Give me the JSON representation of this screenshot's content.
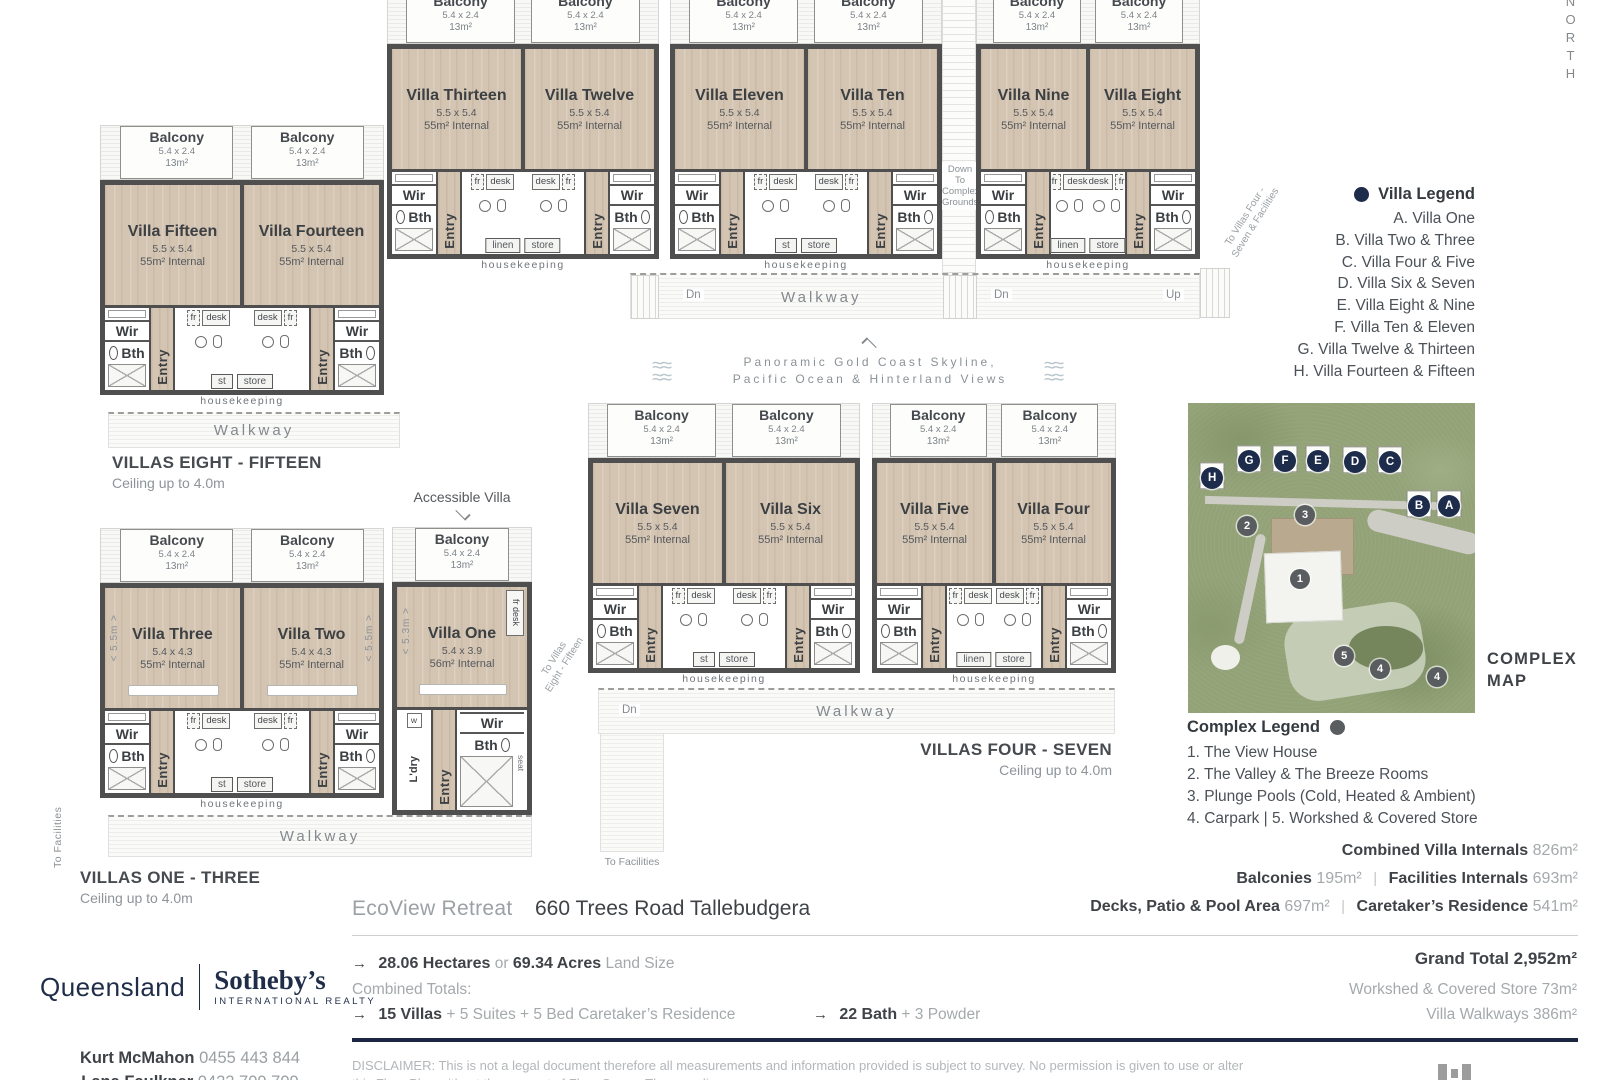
{
  "colors": {
    "navy": "#1e2c4c",
    "wall": "#4f4f50",
    "wood": "#d4c4b2",
    "map_green": "#93a277",
    "rule_navy": "#1b2742",
    "gray_text": "#9aa0a4"
  },
  "north": "NORTH",
  "unit_labels": {
    "balcony": "Balcony",
    "balcony_dims": "5.4 x 2.4",
    "balcony_area": "13m²",
    "wir": "Wir",
    "bth": "Bth",
    "entry": "Entry",
    "fr": "fr",
    "desk": "desk",
    "housekeeping": "housekeeping"
  },
  "pairs": [
    {
      "left": {
        "name": "Villa Thirteen",
        "dims": "5.5 x 5.4",
        "internal": "55m² Internal"
      },
      "right": {
        "name": "Villa Twelve",
        "dims": "5.5 x 5.4",
        "internal": "55m² Internal"
      },
      "store_left": "linen",
      "store_right": "store",
      "box": {
        "l": 387,
        "t": -11,
        "w": 272
      }
    },
    {
      "left": {
        "name": "Villa Eleven",
        "dims": "5.5 x 5.4",
        "internal": "55m² Internal"
      },
      "right": {
        "name": "Villa Ten",
        "dims": "5.5 x 5.4",
        "internal": "55m² Internal"
      },
      "store_left": "st",
      "store_right": "store",
      "box": {
        "l": 670,
        "t": -11,
        "w": 272
      }
    },
    {
      "left": {
        "name": "Villa Nine",
        "dims": "5.5 x 5.4",
        "internal": "55m² Internal"
      },
      "right": {
        "name": "Villa Eight",
        "dims": "5.5 x 5.4",
        "internal": "55m² Internal"
      },
      "store_left": "linen",
      "store_right": "store",
      "box": {
        "l": 976,
        "t": -11,
        "w": 224
      }
    },
    {
      "left": {
        "name": "Villa Fifteen",
        "dims": "5.5 x 5.4",
        "internal": "55m² Internal"
      },
      "right": {
        "name": "Villa Fourteen",
        "dims": "5.5 x 5.4",
        "internal": "55m² Internal"
      },
      "store_left": "st",
      "store_right": "store",
      "box": {
        "l": 100,
        "t": 125,
        "w": 284
      }
    },
    {
      "left": {
        "name": "Villa Seven",
        "dims": "5.5 x 5.4",
        "internal": "55m² Internal"
      },
      "right": {
        "name": "Villa Six",
        "dims": "5.5 x 5.4",
        "internal": "55m² Internal"
      },
      "store_left": "st",
      "store_right": "store",
      "box": {
        "l": 588,
        "t": 403,
        "w": 272
      }
    },
    {
      "left": {
        "name": "Villa Five",
        "dims": "5.5 x 5.4",
        "internal": "55m² Internal"
      },
      "right": {
        "name": "Villa Four",
        "dims": "5.5 x 5.4",
        "internal": "55m² Internal"
      },
      "store_left": "linen",
      "store_right": "store",
      "box": {
        "l": 872,
        "t": 403,
        "w": 244
      }
    },
    {
      "left": {
        "name": "Villa Three",
        "dims": "5.4 x 4.3",
        "internal": "55m² Internal"
      },
      "right": {
        "name": "Villa Two",
        "dims": "5.4 x 4.3",
        "internal": "55m² Internal"
      },
      "store_left": "st",
      "store_right": "store",
      "bed_class": "bed on",
      "dim_left": "< 5.5m >",
      "dim_right": "< 5.5m >",
      "box": {
        "l": 100,
        "t": 528,
        "w": 284
      }
    }
  ],
  "villa_one": {
    "accessible": "Accessible Villa",
    "name": "Villa One",
    "dims": "5.4 x 3.9",
    "internal": "56m² Internal",
    "balcony": "Balcony",
    "balcony_dims": "5.4 x 2.4",
    "balcony_area": "13m²",
    "wir": "Wir",
    "bth": "Bth",
    "entry": "Entry",
    "ldry": "L'dry",
    "w_label": "w",
    "seat": "seat",
    "frdesk": "fr desk",
    "dim": "< 5.3m >",
    "box": {
      "l": 392,
      "t": 527,
      "w": 140
    }
  },
  "sections": [
    {
      "title": "VILLAS EIGHT - FIFTEEN",
      "sub": "Ceiling up to 4.0m",
      "box": {
        "l": 112,
        "t": 453,
        "w": 300,
        "align": "left"
      }
    },
    {
      "title": "VILLAS FOUR - SEVEN",
      "sub": "Ceiling up to 4.0m",
      "box": {
        "l": 872,
        "t": 740,
        "w": 240,
        "align": "right"
      }
    },
    {
      "title": "VILLAS ONE - THREE",
      "sub": "Ceiling up to 4.0m",
      "box": {
        "l": 80,
        "t": 868,
        "w": 300,
        "align": "left"
      }
    }
  ],
  "annotations": {
    "walkway": "Walkway",
    "dn": "Dn",
    "up": "Up",
    "down_to_complex": "Down To\nComplex\nGrounds",
    "to_villas_47": "To Villas Four -\nSeven & Facilities",
    "to_villas_815": "To Villas\nEight - Fifteen",
    "to_facilities": "To Facilities",
    "panoramic_line1": "Panoramic Gold Coast Skyline,",
    "panoramic_line2": "Pacific Ocean & Hinterland Views",
    "waves": "≈≈"
  },
  "villa_legend": {
    "title": "Villa Legend",
    "items": [
      "A. Villa One",
      "B. Villa Two & Three",
      "C. Villa Four & Five",
      "D. Villa Six & Seven",
      "E. Villa Eight & Nine",
      "F. Villa Ten & Eleven",
      "G. Villa Twelve & Thirteen",
      "H. Villa Fourteen & Fifteen"
    ]
  },
  "complex_map": {
    "title": "COMPLEX\nMAP",
    "letter_markers": [
      {
        "label": "H",
        "x": "8.4%",
        "y": "24.2%"
      },
      {
        "label": "G",
        "x": "21.3%",
        "y": "18.7%"
      },
      {
        "label": "F",
        "x": "33.8%",
        "y": "18.7%"
      },
      {
        "label": "E",
        "x": "45.3%",
        "y": "18.7%"
      },
      {
        "label": "D",
        "x": "58.2%",
        "y": "19.0%"
      },
      {
        "label": "C",
        "x": "70.4%",
        "y": "19.0%"
      },
      {
        "label": "B",
        "x": "80.5%",
        "y": "33.2%"
      },
      {
        "label": "A",
        "x": "91.0%",
        "y": "33.2%"
      }
    ],
    "number_markers": [
      {
        "label": "2",
        "x": "20.6%",
        "y": "39.7%"
      },
      {
        "label": "3",
        "x": "40.8%",
        "y": "36.1%"
      },
      {
        "label": "1",
        "x": "39.0%",
        "y": "56.8%"
      },
      {
        "label": "5",
        "x": "54.4%",
        "y": "81.6%"
      },
      {
        "label": "4",
        "x": "66.9%",
        "y": "85.8%"
      },
      {
        "label": "4",
        "x": "86.8%",
        "y": "88.4%"
      }
    ]
  },
  "complex_legend": {
    "title": "Complex Legend",
    "items": [
      "1. The View House",
      "2. The Valley & The Breeze Rooms",
      "3. Plunge Pools (Cold, Heated & Ambient)",
      "4. Carpark  |  5. Workshed & Covered Store"
    ]
  },
  "area_stats": {
    "line1_label": "Combined Villa Internals",
    "line1_value": "826m²",
    "line2a_label": "Balconies",
    "line2a_value": "195m²",
    "line2b_label": "Facilities Internals",
    "line2b_value": "693m²",
    "line3a_label": "Decks, Patio & Pool Area",
    "line3a_value": "697m²",
    "line3b_label": "Caretaker’s Residence",
    "line3b_value": "541m²",
    "sep": "|"
  },
  "footer": {
    "project": "EcoView Retreat",
    "address": "660 Trees Road Tallebudgera",
    "arrow": "→",
    "land_bold1": "28.06 Hectares",
    "land_or": "or",
    "land_bold2": "69.34 Acres",
    "land_suffix": "Land Size",
    "combined_totals": "Combined Totals:",
    "villas_bold": "15 Villas",
    "villas_rest": "+ 5 Suites + 5 Bed Caretaker’s Residence",
    "bath_bold": "22 Bath",
    "bath_rest": "+ 3 Powder",
    "grand_total": "Grand Total 2,952m²",
    "workshed": "Workshed & Covered Store 73m²",
    "walkways": "Villa Walkways 386m²",
    "disclaimer_1": "DISCLAIMER: This is not a legal document therefore all measurements and information provided is subject to survey. No permission is given to use or alter",
    "disclaimer_2": "this Floor Plan without the consent of Floor Scans. The compliance..."
  },
  "agency": {
    "region": "Queensland",
    "brand": "Sotheby’s",
    "sub": "INTERNATIONAL REALTY",
    "agent1_name": "Kurt McMahon",
    "agent1_phone": "0455 443 844",
    "agent2_name": "Lana Faulkner",
    "agent2_phone": "0422 709 709"
  }
}
